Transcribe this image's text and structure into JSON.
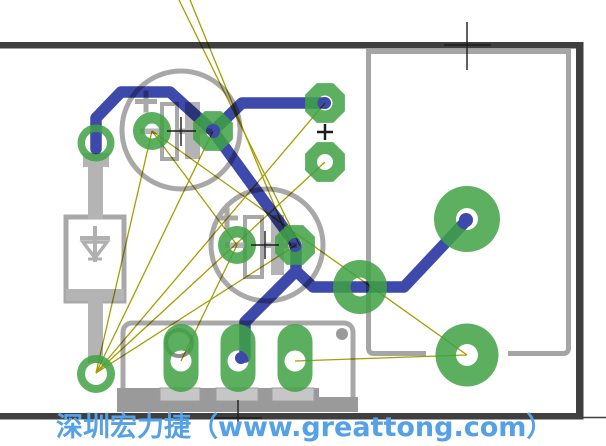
{
  "canvas": {
    "width": 606,
    "height": 446,
    "background": "#FFFFFF"
  },
  "colors": {
    "board_outline": "#3F3F3F",
    "silkscreen": "#A8A8A8",
    "silkscreen_fill": "#B4B4B4",
    "copper": "#3FA244",
    "trace": "#3E49AC",
    "ratsnest": "#A89C00",
    "crosshair": "#1C1C1C",
    "watermark": "#55A1E8"
  },
  "watermark": {
    "text": "深圳宏力捷（www.greattong.com）"
  },
  "board_outline": {
    "bars": [
      {
        "name": "board-edge-top",
        "x": 0,
        "y": 42,
        "w": 583,
        "h": 6.5
      },
      {
        "name": "board-edge-right",
        "x": 576,
        "y": 42,
        "w": 7.5,
        "h": 377.5
      },
      {
        "name": "board-edge-bottom",
        "x": 0,
        "y": 413,
        "w": 583,
        "h": 6.5
      }
    ],
    "corner_tick": {
      "name": "corner-extension-line",
      "x1": 583,
      "y1": 417.5,
      "x2": 606,
      "y2": 417.5
    }
  },
  "silkscreen": [
    {
      "t": "circle",
      "name": "cap1-outline",
      "cx": 181,
      "cy": 130,
      "r": 59,
      "fill": "none",
      "stroke": "#A8A8A8",
      "sw": 5
    },
    {
      "t": "circle",
      "name": "cap2-outline",
      "cx": 267,
      "cy": 245,
      "r": 56,
      "fill": "none",
      "stroke": "#A8A8A8",
      "sw": 5
    },
    {
      "t": "rect",
      "name": "cap1-plus-h",
      "x": 135,
      "y": 99,
      "w": 22,
      "h": 5,
      "fill": "#A8A8A8"
    },
    {
      "t": "rect",
      "name": "cap1-plus-v",
      "x": 143.5,
      "y": 90.5,
      "w": 5,
      "h": 22,
      "fill": "#A8A8A8"
    },
    {
      "t": "rect",
      "name": "cap2-plus-h",
      "x": 216,
      "y": 215.5,
      "w": 22,
      "h": 5,
      "fill": "#A8A8A8"
    },
    {
      "t": "rect",
      "name": "cap2-plus-v",
      "x": 224.5,
      "y": 207,
      "w": 5,
      "h": 22,
      "fill": "#A8A8A8"
    },
    {
      "t": "rect",
      "name": "cap1-lead-line",
      "x": 140,
      "y": 128.5,
      "w": 72,
      "h": 5.5,
      "fill": "#B4B4B4"
    },
    {
      "t": "rect",
      "name": "cap2-lead-line",
      "x": 225,
      "y": 242.5,
      "w": 72,
      "h": 5.5,
      "fill": "#B4B4B4"
    },
    {
      "t": "rect",
      "name": "cap1-bar-outline",
      "x": 162,
      "y": 104,
      "w": 15,
      "h": 55,
      "fill": "#FFFFFF",
      "stroke": "#A8A8A8",
      "sw": 4
    },
    {
      "t": "rect",
      "name": "cap1-bar-fill",
      "x": 185,
      "y": 102,
      "w": 15,
      "h": 57,
      "fill": "#B4B4B4"
    },
    {
      "t": "rect",
      "name": "cap2-bar-outline",
      "x": 245,
      "y": 217,
      "w": 17,
      "h": 60,
      "fill": "#FFFFFF",
      "stroke": "#A8A8A8",
      "sw": 4
    },
    {
      "t": "rect",
      "name": "cap2-bar-fill",
      "x": 271,
      "y": 215,
      "w": 13,
      "h": 60,
      "fill": "#B4B4B4"
    },
    {
      "t": "rect",
      "name": "diode-body",
      "x": 66,
      "y": 217,
      "w": 58,
      "h": 84,
      "fill": "#FFFFFF",
      "stroke": "#A8A8A8",
      "sw": 5
    },
    {
      "t": "rect",
      "name": "diode-band",
      "x": 66,
      "y": 289,
      "w": 58,
      "h": 12,
      "fill": "#B4B4B4"
    },
    {
      "t": "line",
      "name": "diode-symbol-stem",
      "x1": 95,
      "y1": 226,
      "x2": 95,
      "y2": 262,
      "stroke": "#B0B0B0",
      "sw": 4
    },
    {
      "t": "line",
      "name": "diode-symbol-bar",
      "x1": 80,
      "y1": 238,
      "x2": 110,
      "y2": 238,
      "stroke": "#B0B0B0",
      "sw": 4
    },
    {
      "t": "path",
      "name": "diode-symbol-triangle",
      "d": "M83,242 L107,242 L95,258 Z",
      "fill": "none",
      "stroke": "#B0B0B0",
      "sw": 3.5
    },
    {
      "t": "line",
      "name": "diode-symbol-tick",
      "x1": 88,
      "y1": 259,
      "x2": 102,
      "y2": 259,
      "stroke": "#B0B0B0",
      "sw": 3
    },
    {
      "t": "rect",
      "name": "diode-lead-collar",
      "x": 83,
      "y": 153,
      "w": 26,
      "h": 14,
      "fill": "#B4B4B4"
    },
    {
      "t": "rect",
      "name": "diode-lead-top",
      "x": 88,
      "y": 167,
      "w": 15,
      "h": 52,
      "fill": "#B4B4B4"
    },
    {
      "t": "rect",
      "name": "diode-lead-bottom",
      "x": 88,
      "y": 299,
      "w": 15,
      "h": 64,
      "fill": "#B4B4B4"
    },
    {
      "t": "rect",
      "name": "connector-body",
      "x": 123,
      "y": 323,
      "w": 230,
      "h": 85,
      "rx": 9,
      "fill": "#FFFFFF",
      "stroke": "#A8A8A8",
      "sw": 5
    },
    {
      "t": "rect",
      "name": "connector-flange",
      "x": 117,
      "y": 388,
      "w": 202,
      "h": 24,
      "fill": "#9A9A9A"
    },
    {
      "t": "rect",
      "name": "connector-flange-right",
      "x": 318,
      "y": 397,
      "w": 40,
      "h": 15,
      "fill": "#9A9A9A"
    },
    {
      "t": "rect",
      "name": "connector-tab-1",
      "x": 160,
      "y": 388,
      "w": 40,
      "h": 13,
      "fill": "#C6C6C6",
      "stroke": "#9E9E9E",
      "sw": 1
    },
    {
      "t": "rect",
      "name": "connector-tab-2",
      "x": 216,
      "y": 388,
      "w": 42,
      "h": 13,
      "fill": "#C6C6C6",
      "stroke": "#9E9E9E",
      "sw": 1
    },
    {
      "t": "rect",
      "name": "connector-tab-3",
      "x": 272,
      "y": 388,
      "w": 42,
      "h": 13,
      "fill": "#C6C6C6",
      "stroke": "#9E9E9E",
      "sw": 1
    },
    {
      "t": "circle",
      "name": "connector-hole",
      "cx": 342,
      "cy": 334,
      "r": 6,
      "fill": "#9A9A9A"
    },
    {
      "t": "circle",
      "name": "pin1-marker",
      "cx": 179,
      "cy": 343,
      "r": 13,
      "fill": "none",
      "stroke": "#8F8F8F",
      "sw": 4
    },
    {
      "t": "path",
      "name": "ic-outline",
      "d": "M368.5,53 L368.5,348 Q368.5,353.5 374,353.5 L426,353.5 M508,353.5 L563,353.5 Q568.5,353.5 568.5,348 L568.5,53 M366,51.5 L571,51.5",
      "fill": "none",
      "stroke": "#A5A5A5",
      "sw": 5
    }
  ],
  "ratsnest": {
    "width": 1.3,
    "segments": [
      {
        "name": "ratsnest-line",
        "pts": [
          179,
          0,
          300,
          246
        ]
      },
      {
        "name": "ratsnest-line",
        "pts": [
          190,
          0,
          291,
          246
        ]
      },
      {
        "name": "ratsnest-line",
        "pts": [
          96,
          373,
          152,
          131
        ]
      },
      {
        "name": "ratsnest-line",
        "pts": [
          96,
          373,
          296,
          245
        ]
      },
      {
        "name": "ratsnest-line",
        "pts": [
          152,
          131,
          467,
          355
        ]
      },
      {
        "name": "ratsnest-line",
        "pts": [
          96,
          373,
          325,
          162
        ]
      },
      {
        "name": "ratsnest-line",
        "pts": [
          295,
          361,
          467,
          355
        ]
      },
      {
        "name": "ratsnest-line",
        "pts": [
          152,
          131,
          237,
          245
        ]
      },
      {
        "name": "ratsnest-line",
        "pts": [
          237,
          245,
          181,
          361
        ]
      },
      {
        "name": "ratsnest-line",
        "pts": [
          96,
          373,
          213,
          131
        ]
      },
      {
        "name": "ratsnest-line",
        "pts": [
          96,
          373,
          325,
          103
        ]
      }
    ]
  },
  "traces": {
    "width": 11.5,
    "paths": [
      {
        "name": "trace-diode-to-cap1",
        "pts": [
          [
            96,
            149
          ],
          [
            96,
            118
          ],
          [
            121,
            92
          ],
          [
            170,
            92
          ],
          [
            213,
            131
          ]
        ]
      },
      {
        "name": "trace-cap1-to-via1",
        "pts": [
          [
            213,
            131
          ],
          [
            242,
            103
          ],
          [
            325,
            103
          ]
        ]
      },
      {
        "name": "trace-cap1-to-cap2",
        "pts": [
          [
            213,
            131
          ],
          [
            296,
            245
          ],
          [
            296,
            271
          ]
        ]
      },
      {
        "name": "trace-cap2-to-connector",
        "pts": [
          [
            296,
            271
          ],
          [
            245,
            322
          ],
          [
            245,
            357
          ]
        ]
      },
      {
        "name": "trace-cap2-to-via-large",
        "pts": [
          [
            296,
            271
          ],
          [
            313,
            287
          ],
          [
            404,
            287
          ],
          [
            466,
            221
          ]
        ]
      }
    ],
    "end_dots": [
      {
        "name": "trace-end-dot",
        "cx": 466,
        "cy": 220,
        "r": 7
      },
      {
        "name": "trace-end-dot",
        "cx": 325,
        "cy": 103,
        "r": 6
      },
      {
        "name": "trace-end-dot",
        "cx": 213,
        "cy": 131,
        "r": 6
      },
      {
        "name": "trace-end-dot",
        "cx": 295,
        "cy": 245,
        "r": 6
      },
      {
        "name": "trace-end-dot",
        "cx": 241,
        "cy": 358,
        "r": 6
      }
    ]
  },
  "pads": [
    {
      "shape": "ring",
      "name": "diode-pad-top",
      "cx": 96,
      "cy": 143,
      "r": 18.5,
      "hole": 11
    },
    {
      "shape": "ring",
      "name": "cap1-pad-neg",
      "cx": 152,
      "cy": 131,
      "r": 19,
      "hole": 7.5
    },
    {
      "shape": "octagon",
      "name": "cap1-pad-pos",
      "cx": 213,
      "cy": 131,
      "r": 21.5,
      "hole": 7
    },
    {
      "shape": "ring",
      "name": "cap2-pad-neg",
      "cx": 237,
      "cy": 245,
      "r": 19,
      "hole": 7.5
    },
    {
      "shape": "octagon",
      "name": "cap2-pad-pos",
      "cx": 295,
      "cy": 245,
      "r": 21.5,
      "hole": 7
    },
    {
      "shape": "octagon",
      "name": "via-pad-1",
      "cx": 325,
      "cy": 103,
      "r": 21.5,
      "hole": 7.5
    },
    {
      "shape": "octagon",
      "name": "via-pad-2",
      "cx": 325,
      "cy": 162,
      "r": 21.5,
      "hole": 8
    },
    {
      "shape": "ring",
      "name": "diode-pad-bottom",
      "cx": 96,
      "cy": 374,
      "r": 19,
      "hole": 11
    },
    {
      "shape": "ring",
      "name": "via-large-1",
      "cx": 360,
      "cy": 287,
      "r": 27,
      "hole": 9.5
    },
    {
      "shape": "ring",
      "name": "via-large-2",
      "cx": 467,
      "cy": 219,
      "r": 33,
      "hole": 11
    },
    {
      "shape": "ring",
      "name": "via-large-3",
      "cx": 467,
      "cy": 355,
      "r": 31.5,
      "hole": 11
    },
    {
      "shape": "oval",
      "name": "connector-pad-1",
      "cx": 181,
      "cy": 358,
      "w": 35,
      "h": 68,
      "hole": 10.5
    },
    {
      "shape": "oval",
      "name": "connector-pad-2",
      "cx": 238,
      "cy": 358,
      "w": 35,
      "h": 68,
      "hole": 10.5
    },
    {
      "shape": "oval",
      "name": "connector-pad-3",
      "cx": 295,
      "cy": 358,
      "w": 35,
      "h": 68,
      "hole": 10.5
    }
  ],
  "crosshairs": [
    {
      "name": "registration-crosshair-top",
      "lines": [
        [
          444,
          45,
          491,
          45
        ],
        [
          467,
          22,
          467,
          70
        ]
      ],
      "w": 1.4
    },
    {
      "name": "registration-crosshair-bottom",
      "lines": [
        [
          214,
          418,
          262,
          418
        ],
        [
          238,
          400,
          238,
          434
        ]
      ],
      "w": 1.4
    },
    {
      "name": "cap1-center-crosshair",
      "lines": [
        [
          167,
          131,
          196,
          131
        ],
        [
          181,
          117,
          181,
          146
        ]
      ],
      "w": 1.4
    },
    {
      "name": "cap2-center-crosshair",
      "lines": [
        [
          251,
          245,
          279,
          245
        ],
        [
          265,
          231,
          265,
          259
        ]
      ],
      "w": 1.4
    },
    {
      "name": "via-plus-mark",
      "lines": [
        [
          317,
          132,
          333,
          132
        ],
        [
          325,
          124,
          325,
          140
        ]
      ],
      "w": 2.5
    }
  ]
}
